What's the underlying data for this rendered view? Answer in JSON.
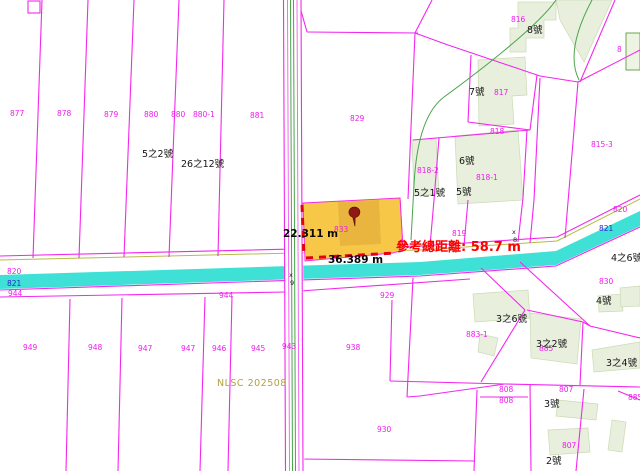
{
  "watermark": "NLSC 202508",
  "measurements": {
    "side_a": "22.311 m",
    "side_b": "36.389 m",
    "total_label": "參考總距離: 58.7 m"
  },
  "selected_parcel": {
    "id": "833",
    "fill": "#f7c848",
    "pin": "red-pushpin"
  },
  "colors": {
    "parcel_line": "#f327ee",
    "parcel_label": "#ee1cee",
    "river": "#3fe1d6",
    "river_label": "#2727cc",
    "building_fill": "#e8efdd",
    "road_edge_green": "#4ba34b",
    "bank_line_olive": "#b5bc45",
    "measure_dash": "#e3000f",
    "total_text": "#fe0000",
    "watermark_text": "#b0a23f"
  },
  "labels": [
    {
      "text": "877",
      "x": 10,
      "y": 116,
      "c": "m"
    },
    {
      "text": "878",
      "x": 57,
      "y": 116,
      "c": "m"
    },
    {
      "text": "879",
      "x": 104,
      "y": 117,
      "c": "m"
    },
    {
      "text": "880",
      "x": 144,
      "y": 117,
      "c": "m"
    },
    {
      "text": "880",
      "x": 171,
      "y": 117,
      "c": "m"
    },
    {
      "text": "880-1",
      "x": 193,
      "y": 117,
      "c": "m"
    },
    {
      "text": "881",
      "x": 250,
      "y": 118,
      "c": "m"
    },
    {
      "text": "829",
      "x": 350,
      "y": 121,
      "c": "m"
    },
    {
      "text": "816",
      "x": 511,
      "y": 22,
      "c": "m"
    },
    {
      "text": "817",
      "x": 494,
      "y": 95,
      "c": "m"
    },
    {
      "text": "818",
      "x": 490,
      "y": 134,
      "c": "m"
    },
    {
      "text": "818-2",
      "x": 417,
      "y": 173,
      "c": "m"
    },
    {
      "text": "818-1",
      "x": 476,
      "y": 180,
      "c": "m"
    },
    {
      "text": "815-3",
      "x": 591,
      "y": 147,
      "c": "m"
    },
    {
      "text": "8",
      "x": 617,
      "y": 52,
      "c": "m"
    },
    {
      "text": "819",
      "x": 452,
      "y": 236,
      "c": "m"
    },
    {
      "text": "833",
      "x": 334,
      "y": 232,
      "c": "m"
    },
    {
      "text": "820",
      "x": 7,
      "y": 274,
      "c": "m"
    },
    {
      "text": "944",
      "x": 8,
      "y": 296,
      "c": "m"
    },
    {
      "text": "944",
      "x": 219,
      "y": 298,
      "c": "m"
    },
    {
      "text": "929",
      "x": 380,
      "y": 298,
      "c": "m"
    },
    {
      "text": "820",
      "x": 613,
      "y": 212,
      "c": "m"
    },
    {
      "text": "830",
      "x": 599,
      "y": 284,
      "c": "m"
    },
    {
      "text": "883-1",
      "x": 466,
      "y": 337,
      "c": "m"
    },
    {
      "text": "885",
      "x": 539,
      "y": 351,
      "c": "m"
    },
    {
      "text": "808",
      "x": 499,
      "y": 392,
      "c": "m"
    },
    {
      "text": "808",
      "x": 499,
      "y": 403,
      "c": "m"
    },
    {
      "text": "807",
      "x": 559,
      "y": 392,
      "c": "m"
    },
    {
      "text": "807",
      "x": 562,
      "y": 448,
      "c": "m"
    },
    {
      "text": "885",
      "x": 628,
      "y": 400,
      "c": "m"
    },
    {
      "text": "949",
      "x": 23,
      "y": 350,
      "c": "m"
    },
    {
      "text": "948",
      "x": 88,
      "y": 350,
      "c": "m"
    },
    {
      "text": "947",
      "x": 138,
      "y": 351,
      "c": "m"
    },
    {
      "text": "947",
      "x": 181,
      "y": 351,
      "c": "m"
    },
    {
      "text": "946",
      "x": 212,
      "y": 351,
      "c": "m"
    },
    {
      "text": "945",
      "x": 251,
      "y": 351,
      "c": "m"
    },
    {
      "text": "943",
      "x": 282,
      "y": 349,
      "c": "m"
    },
    {
      "text": "938",
      "x": 346,
      "y": 350,
      "c": "m"
    },
    {
      "text": "930",
      "x": 377,
      "y": 432,
      "c": "m"
    },
    {
      "text": "821",
      "x": 7,
      "y": 286,
      "c": "bl"
    },
    {
      "text": "821",
      "x": 599,
      "y": 231,
      "c": "bl"
    },
    {
      "text": "5之2號",
      "x": 142,
      "y": 157,
      "c": "b"
    },
    {
      "text": "26之12號",
      "x": 181,
      "y": 167,
      "c": "b"
    },
    {
      "text": "8號",
      "x": 527,
      "y": 33,
      "c": "b"
    },
    {
      "text": "7號",
      "x": 469,
      "y": 95,
      "c": "b"
    },
    {
      "text": "6號",
      "x": 459,
      "y": 164,
      "c": "b"
    },
    {
      "text": "5之1號",
      "x": 414,
      "y": 196,
      "c": "b"
    },
    {
      "text": "5號",
      "x": 456,
      "y": 195,
      "c": "b"
    },
    {
      "text": "4之6號",
      "x": 611,
      "y": 261,
      "c": "b"
    },
    {
      "text": "4號",
      "x": 596,
      "y": 304,
      "c": "b"
    },
    {
      "text": "3之6號",
      "x": 496,
      "y": 322,
      "c": "b"
    },
    {
      "text": "3之2號",
      "x": 536,
      "y": 347,
      "c": "b"
    },
    {
      "text": "3之4號",
      "x": 606,
      "y": 366,
      "c": "b"
    },
    {
      "text": "3號",
      "x": 544,
      "y": 407,
      "c": "b"
    },
    {
      "text": "2號",
      "x": 546,
      "y": 464,
      "c": "b"
    },
    {
      "text": "x",
      "x": 289,
      "y": 277,
      "c": "t"
    },
    {
      "text": "9",
      "x": 290,
      "y": 285,
      "c": "t"
    },
    {
      "text": "x",
      "x": 512,
      "y": 234,
      "c": "t"
    },
    {
      "text": "8",
      "x": 513,
      "y": 242,
      "c": "t"
    }
  ]
}
